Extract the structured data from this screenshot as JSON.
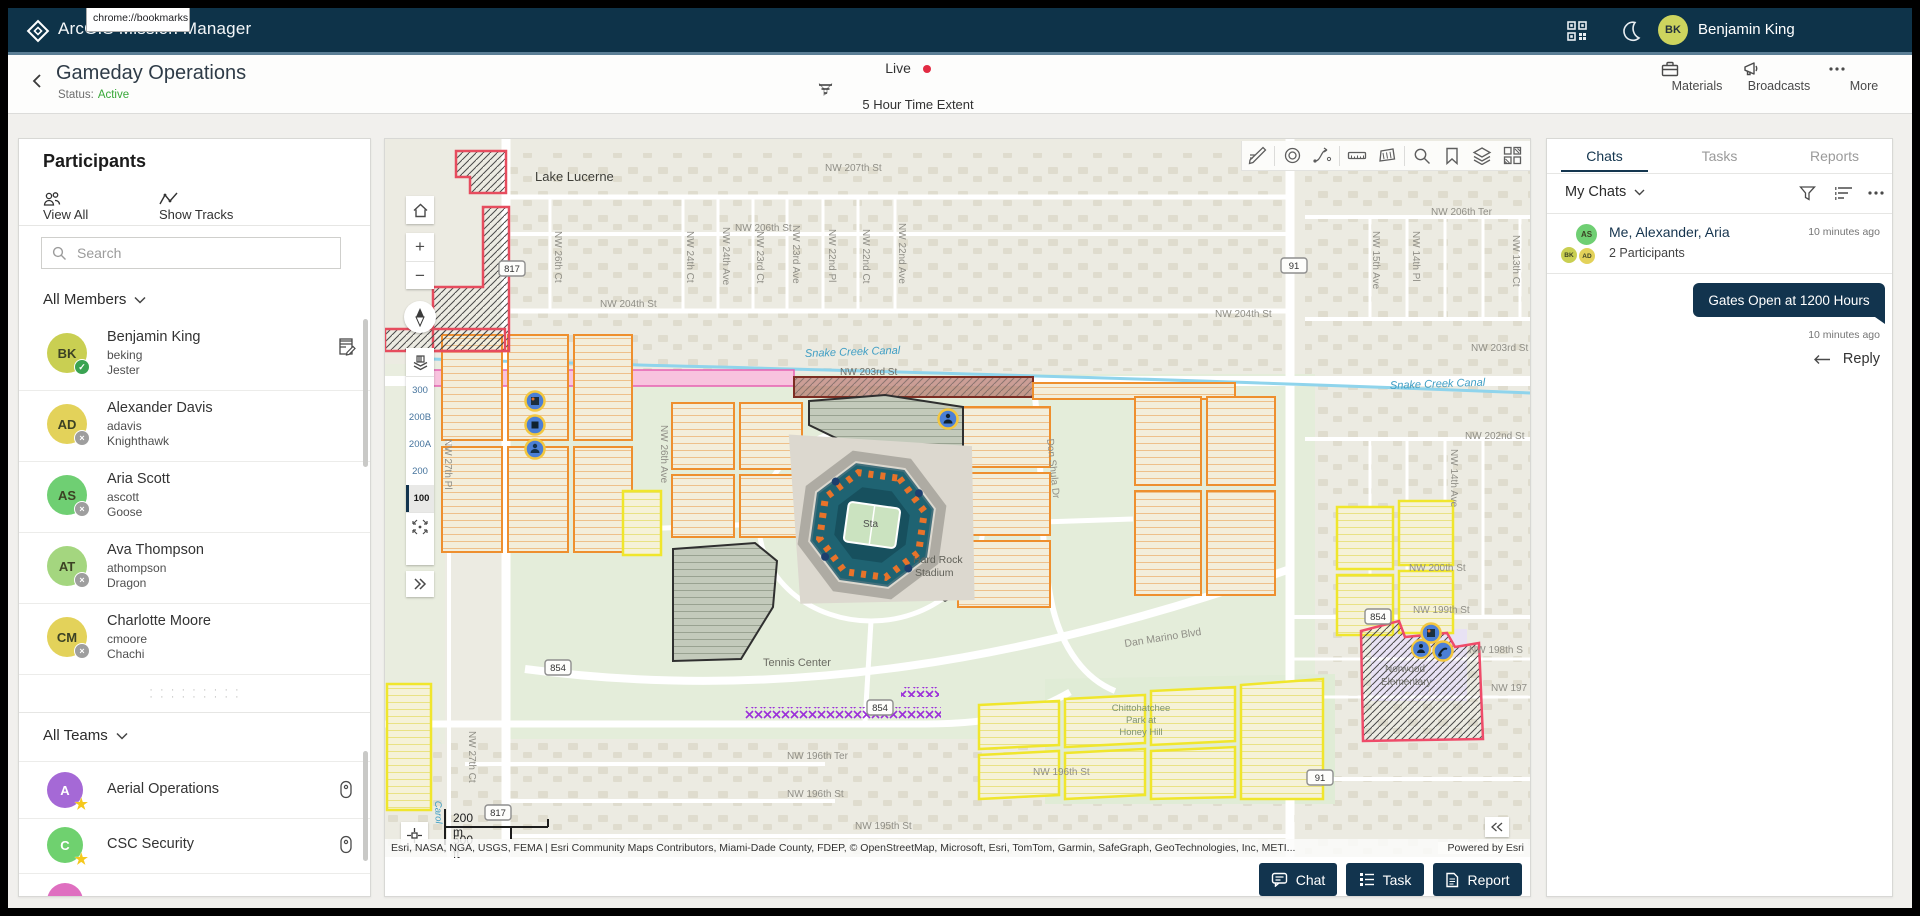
{
  "app": {
    "title": "ArcGIS Mission Manager",
    "user_name": "Benjamin King",
    "user_initials": "BK",
    "avatar_color": "#cdd45e",
    "topbar_color": "#0e3349"
  },
  "browser_tooltip": {
    "line1": "bookmarks",
    "line2": "chrome://bookmarks"
  },
  "mission": {
    "title": "Gameday Operations",
    "status_label": "Status:",
    "status_value": "Active",
    "active_color": "#38a838",
    "live_label": "Live",
    "live_dot_color": "#e22b43",
    "time_extent_label": "5 Hour Time Extent"
  },
  "header_actions": {
    "materials": "Materials",
    "broadcasts": "Broadcasts",
    "more": "More"
  },
  "participants": {
    "title": "Participants",
    "view_all": "View All",
    "show_tracks": "Show Tracks",
    "search_placeholder": "Search",
    "members_filter": "All Members",
    "teams_filter": "All Teams",
    "handle_dots": "· · · · · · · · ·",
    "members": [
      {
        "initials": "BK",
        "name": "Benjamin King",
        "username": "beking",
        "callsign": "Jester",
        "color": "#c9cf52",
        "badge": "check"
      },
      {
        "initials": "AD",
        "name": "Alexander Davis",
        "username": "adavis",
        "callsign": "Knighthawk",
        "color": "#e3d25a",
        "badge": "x"
      },
      {
        "initials": "AS",
        "name": "Aria Scott",
        "username": "ascott",
        "callsign": "Goose",
        "color": "#6fcf73",
        "badge": "x"
      },
      {
        "initials": "AT",
        "name": "Ava Thompson",
        "username": "athompson",
        "callsign": "Dragon",
        "color": "#a4d67f",
        "badge": "x"
      },
      {
        "initials": "CM",
        "name": "Charlotte Moore",
        "username": "cmoore",
        "callsign": "Chachi",
        "color": "#e3d25a",
        "badge": "x"
      }
    ],
    "teams": [
      {
        "initial": "A",
        "name": "Aerial Operations",
        "color": "#a569d6"
      },
      {
        "initial": "C",
        "name": "CSC Security",
        "color": "#6fd16f"
      }
    ],
    "partial_team_color": "#df6fc0"
  },
  "map": {
    "toolbar_icons": [
      "sketch-icon",
      "target-icon",
      "route-icon",
      "measure-distance-icon",
      "measure-area-icon",
      "search-icon",
      "bookmark-icon",
      "layers-icon",
      "basemap-icon"
    ],
    "floors": [
      "300",
      "200B",
      "200A",
      "200",
      "100"
    ],
    "selected_floor": "100",
    "scale_metric": "200 m",
    "scale_imperial": "500 ft",
    "attribution": "Esri, NASA, NGA, USGS, FEMA | Esri Community Maps Contributors, Miami-Dade County, FDEP, © OpenStreetMap, Microsoft, Esri, TomTom, Garmin, SafeGraph, GeoTechnologies, Inc, METI...",
    "powered_by": "Powered by Esri",
    "shields": [
      "817",
      "854",
      "817",
      "854",
      "854",
      "91",
      "91"
    ],
    "labels": [
      "Lake Lucerne",
      "NW 207th St",
      "NW 206th St",
      "NW 204th St",
      "NW 204th St",
      "NW 203rd St",
      "NW 203rd St",
      "NW 202nd St",
      "NW 206th Ter",
      "Snake Creek Canal",
      "Snake Creek Canal",
      "NW 26th Ave",
      "NW 26th Ct",
      "NW 27th Pl",
      "NW 27th Ct",
      "NW 24th Ct",
      "NW 24th Ave",
      "NW 23rd Ct",
      "NW 23rd Ave",
      "NW 22nd Pl",
      "NW 22nd Ct",
      "NW 22nd Ave",
      "NW 15th Ave",
      "NW 14th Pl",
      "NW 13th Ct",
      "NW 14th Ave",
      "Don Shula Dr",
      "Dan Marino Blvd",
      "Tennis Center",
      "Hard Rock",
      "Stadium",
      "Sta",
      "NW 196th Ter",
      "NW 196th St",
      "NW 196th St",
      "NW 195th St",
      "NW 199th St",
      "NW 198th S",
      "NW 197",
      "NW 200th St",
      "Chittohatchee",
      "Park at",
      "Honey Hill",
      "Norwood",
      "Elementary",
      "Carol"
    ]
  },
  "map_actions": {
    "chat": "Chat",
    "task": "Task",
    "report": "Report"
  },
  "chat_panel": {
    "tabs": [
      "Chats",
      "Tasks",
      "Reports"
    ],
    "active_tab": "Chats",
    "filter_label": "My Chats",
    "thread": {
      "title": "Me, Alexander, Aria",
      "time": "10 minutes ago",
      "participants_count": "2 Participants",
      "avatar_initials": [
        "AS",
        "BK",
        "AD"
      ],
      "avatar_colors": [
        "#6fcf73",
        "#c9cf52",
        "#e3d25a"
      ]
    },
    "message": {
      "text": "Gates Open at 1200 Hours",
      "time": "10 minutes ago",
      "reply_label": "Reply",
      "bubble_color": "#12344e"
    }
  }
}
